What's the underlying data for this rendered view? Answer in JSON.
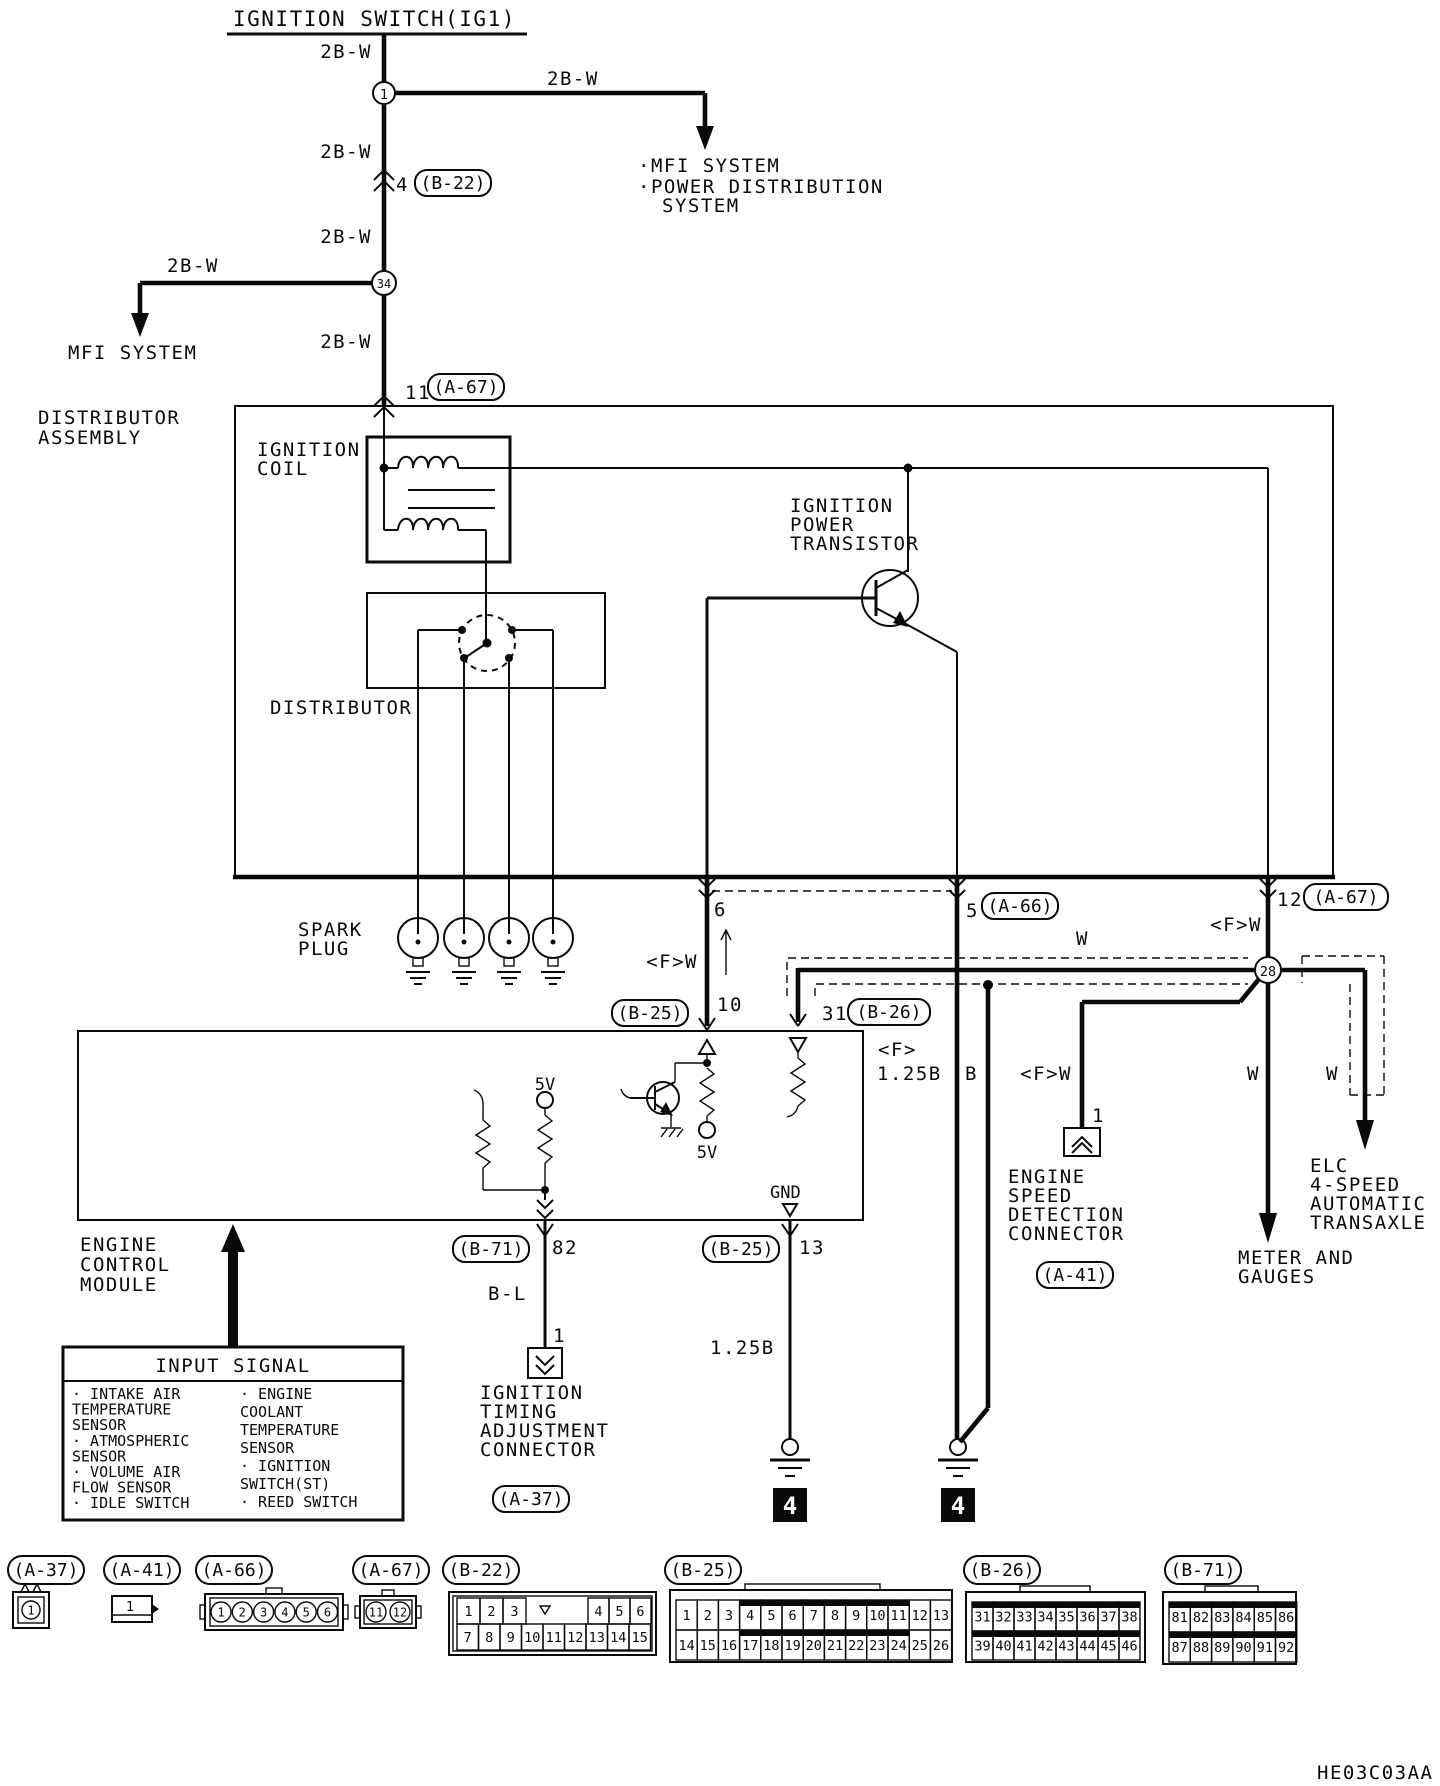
{
  "title": "IGNITION SWITCH(IG1)",
  "diagram_code": "HE03C03AA",
  "wire_labels": {
    "trunk_1": "2B-W",
    "trunk_2": "2B-W",
    "trunk_3": "2B-W",
    "trunk_4": "2B-W",
    "branch_right": "2B-W",
    "branch_left": "2B-W",
    "pin6_code": "<F>W",
    "pin12_code": "<F>W",
    "a41_code": "<F>W",
    "shield_code_f": "<F>",
    "shield_code_size": "1.25B",
    "shield_drain": "B",
    "shield_w": "W",
    "meter_w": "W",
    "elc_w": "W",
    "b71_code": "B-L",
    "gnd13_code": "1.25B"
  },
  "nodes": {
    "n1": "1",
    "n34": "34",
    "n28": "28"
  },
  "pins": {
    "b22": {
      "no": "4",
      "ref": "(B-22)"
    },
    "a67_in": {
      "no": "11",
      "ref": "(A-67)"
    },
    "a67_out": {
      "no": "12",
      "ref": "(A-67)"
    },
    "a66_out": {
      "no": "5",
      "ref": "(A-66)"
    },
    "dist_out": {
      "no": "6"
    },
    "b25_in": {
      "no": "10",
      "ref": "(B-25)"
    },
    "b26_in": {
      "no": "31",
      "ref": "(B-26)"
    },
    "b71_out": {
      "no": "82",
      "ref": "(B-71)"
    },
    "b25_gnd": {
      "no": "13",
      "ref": "(B-25)"
    },
    "itac": {
      "no": "1",
      "ref": "(A-37)"
    },
    "esdc": {
      "no": "1",
      "ref": "(A-41)"
    }
  },
  "texts": {
    "mfi_left": "MFI SYSTEM",
    "mfi_right": "·MFI SYSTEM",
    "pds_1": "·POWER DISTRIBUTION",
    "pds_2": "SYSTEM",
    "dist_assy_1": "DISTRIBUTOR",
    "dist_assy_2": "ASSEMBLY",
    "coil_1": "IGNITION",
    "coil_2": "COIL",
    "ipt_1": "IGNITION",
    "ipt_2": "POWER",
    "ipt_3": "TRANSISTOR",
    "distributor": "DISTRIBUTOR",
    "spark_1": "SPARK",
    "spark_2": "PLUG",
    "ecm_1": "ENGINE",
    "ecm_2": "CONTROL",
    "ecm_3": "MODULE",
    "v5_a": "5V",
    "v5_b": "5V",
    "gnd": "GND",
    "itac_1": "IGNITION",
    "itac_2": "TIMING",
    "itac_3": "ADJUSTMENT",
    "itac_4": "CONNECTOR",
    "esdc_1": "ENGINE",
    "esdc_2": "SPEED",
    "esdc_3": "DETECTION",
    "esdc_4": "CONNECTOR",
    "meter_1": "METER AND",
    "meter_2": "GAUGES",
    "elc_1": "ELC",
    "elc_2": "4-SPEED",
    "elc_3": "AUTOMATIC",
    "elc_4": "TRANSAXLE",
    "gnd_block_1": "4",
    "gnd_block_2": "4"
  },
  "input_signal": {
    "header": "INPUT SIGNAL",
    "col1": [
      "· INTAKE AIR",
      "  TEMPERATURE",
      "  SENSOR",
      "· ATMOSPHERIC",
      "  SENSOR",
      "· VOLUME AIR",
      "  FLOW SENSOR",
      "· IDLE SWITCH"
    ],
    "col2": [
      "· ENGINE",
      "  COOLANT",
      "  TEMPERATURE",
      "  SENSOR",
      "· IGNITION",
      "  SWITCH(ST)",
      "· REED SWITCH"
    ]
  },
  "bottom_connectors": {
    "a37": {
      "label": "(A-37)",
      "pins": [
        "1"
      ]
    },
    "a41": {
      "label": "(A-41)",
      "pins": [
        "1"
      ]
    },
    "a66": {
      "label": "(A-66)",
      "pins": [
        "1",
        "2",
        "3",
        "4",
        "5",
        "6"
      ]
    },
    "a67": {
      "label": "(A-67)",
      "pins": [
        "11",
        "12"
      ]
    },
    "b22": {
      "label": "(B-22)",
      "row1": [
        "1",
        "2",
        "3",
        "4",
        "5",
        "6"
      ],
      "row2": [
        "7",
        "8",
        "9",
        "10",
        "11",
        "12",
        "13",
        "14",
        "15"
      ]
    },
    "b25": {
      "label": "(B-25)",
      "row1": [
        "1",
        "2",
        "3",
        "4",
        "5",
        "6",
        "7",
        "8",
        "9",
        "10",
        "11",
        "12",
        "13"
      ],
      "row2": [
        "14",
        "15",
        "16",
        "17",
        "18",
        "19",
        "20",
        "21",
        "22",
        "23",
        "24",
        "25",
        "26"
      ]
    },
    "b26": {
      "label": "(B-26)",
      "row1": [
        "31",
        "32",
        "33",
        "34",
        "35",
        "36",
        "37",
        "38"
      ],
      "row2": [
        "39",
        "40",
        "41",
        "42",
        "43",
        "44",
        "45",
        "46"
      ]
    },
    "b71": {
      "label": "(B-71)",
      "row1": [
        "81",
        "82",
        "83",
        "84",
        "85",
        "86"
      ],
      "row2": [
        "87",
        "88",
        "89",
        "90",
        "91",
        "92"
      ]
    }
  }
}
